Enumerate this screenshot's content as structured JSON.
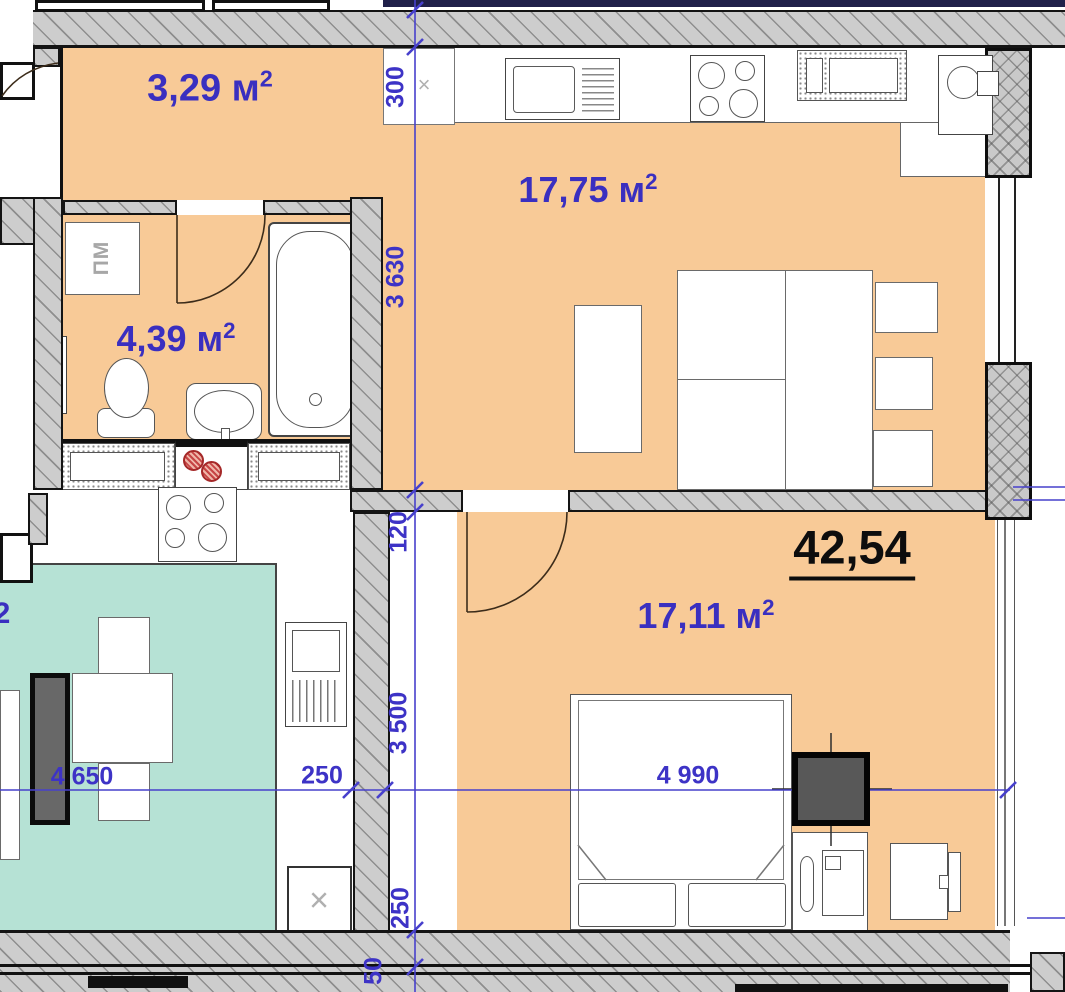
{
  "plan": {
    "total_area": "42,54",
    "rooms": {
      "balcony": {
        "area": "3,29 м",
        "sup": "2"
      },
      "kitchen_living": {
        "area": "17,75 м",
        "sup": "2"
      },
      "bathroom": {
        "area": "4,39 м",
        "sup": "2"
      },
      "bedroom": {
        "area": "17,11 м",
        "sup": "2"
      },
      "neighbor_partial_sup": "2"
    },
    "dimensions": {
      "v300": "300",
      "v3630": "3 630",
      "v120": "120",
      "v3500": "3 500",
      "v250": "250",
      "v50": "50",
      "h4650": "4 650",
      "h250": "250",
      "h4990": "4 990"
    },
    "fixtures": {
      "washing_machine": "ПМ",
      "shaft_mark": "×",
      "kitchen_mark": "×"
    },
    "colors": {
      "floor_orange": "#f8ca97",
      "floor_teal": "#b6e2d5",
      "dimension_blue": "#3d33c6",
      "label_blue": "#3a2fc0",
      "wall_gray": "#cdcdcd"
    }
  }
}
